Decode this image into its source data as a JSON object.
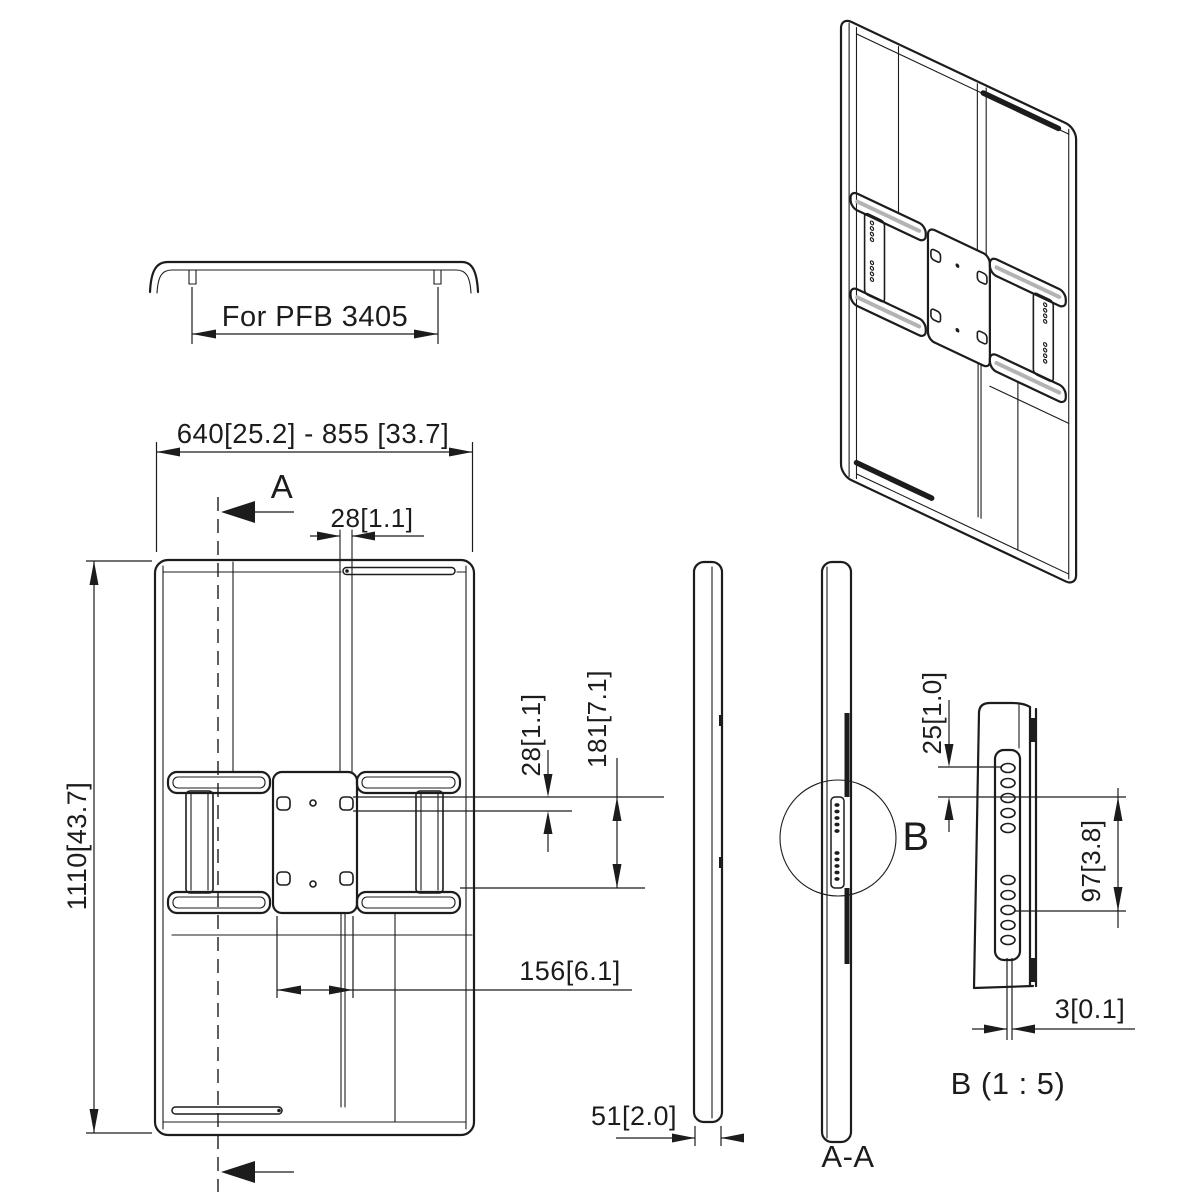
{
  "drawing": {
    "title_hint": "Technical drawing of display mount bracket",
    "top_view": {
      "label": "For PFB 3405"
    },
    "front_view": {
      "width_dim": "640[25.2] - 855 [33.7]",
      "slot_width_dim": "28[1.1]",
      "hole_height_dim": "28[1.1]",
      "hole_span_dim": "181[7.1]",
      "height_dim": "1110[43.7]",
      "hole_width_dim": "156[6.1]",
      "section_letter": "A"
    },
    "side_views": {
      "depth_dim": "51[2.0]",
      "section_label": "A-A",
      "detail_letter": "B"
    },
    "detail_view": {
      "hole_pitch_dim": "25[1.0]",
      "group_span_dim": "97[3.8]",
      "thickness_dim": "3[0.1]",
      "title": "B (1 : 5)"
    },
    "colors": {
      "line": "#1c1c1c",
      "accent": "#b3b3b3",
      "background": "#ffffff"
    }
  }
}
